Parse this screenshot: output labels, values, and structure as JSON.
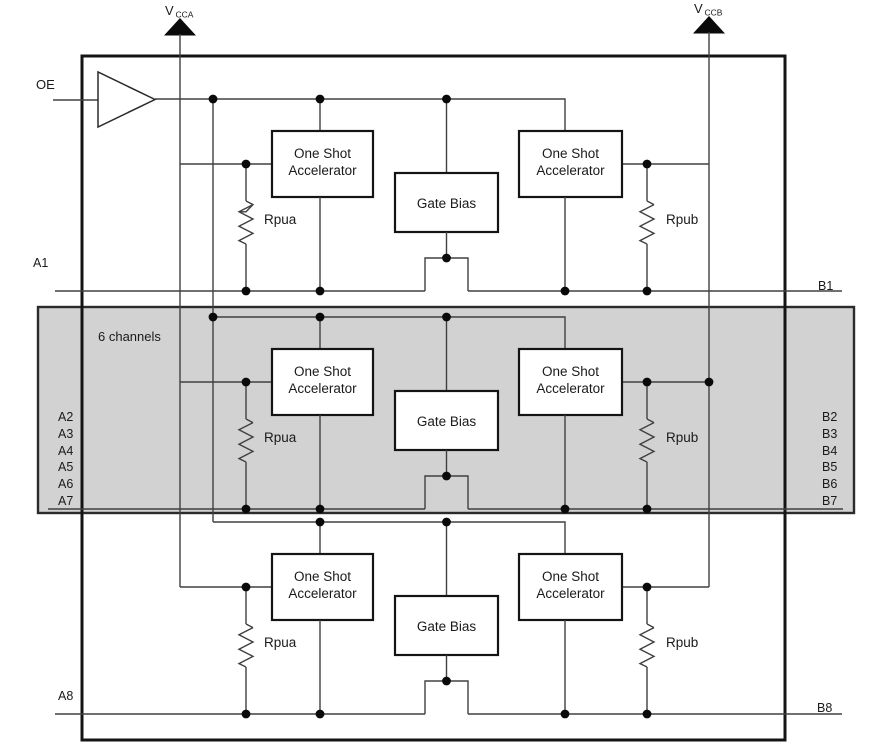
{
  "diagram": {
    "type": "functional-block-diagram",
    "labels": {
      "six_channels": "6 channels",
      "one_shot_line1": "One Shot",
      "one_shot_line2": "Accelerator",
      "gate_bias": "Gate Bias",
      "rpua": "Rpua",
      "rpub": "Rpub"
    },
    "power": {
      "vcca": {
        "v": "V",
        "sub": "CCA"
      },
      "vccb": {
        "v": "V",
        "sub": "CCB"
      }
    },
    "pins": {
      "oe": "OE",
      "a1": "A1",
      "a8": "A8",
      "b1": "B1",
      "b8": "B8",
      "a_group": [
        "A2",
        "A3",
        "A4",
        "A5",
        "A6",
        "A7"
      ],
      "b_group": [
        "B2",
        "B3",
        "B4",
        "B5",
        "B6",
        "B7"
      ]
    },
    "colors": {
      "shaded_fill": "#d2d2d2",
      "wire": "#404040",
      "box_stroke": "#141414",
      "dot": "#0a0a0a",
      "text": "#1a1a1a"
    }
  }
}
